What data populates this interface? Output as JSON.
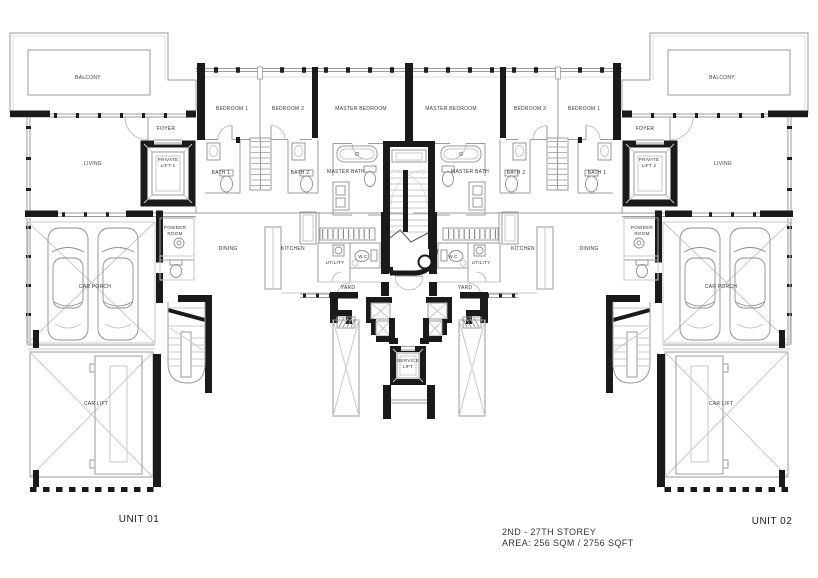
{
  "units": {
    "unit1": {
      "name": "UNIT 01",
      "rooms": {
        "balcony": "BALCONY",
        "bedroom1": "BEDROOM 1",
        "bedroom2": "BEDROOM 2",
        "master_bedroom": "MASTER BEDROOM",
        "foyer": "FOYER",
        "living": "LIVING",
        "private_lift": "PRIVATE\nLIFT-1",
        "bath1": "BATH 1",
        "bath2": "BATH 2",
        "master_bath": "MASTER BATH",
        "powder_room": "POWDER\nROOM",
        "dining": "DINING",
        "kitchen": "KITCHEN",
        "utility": "UTILITY",
        "wc": "W.C",
        "yard": "YARD",
        "car_porch": "CAR PORCH",
        "car_lift": "CAR LIFT"
      }
    },
    "unit2": {
      "name": "UNIT 02",
      "rooms": {
        "balcony": "BALCONY",
        "bedroom1": "BEDROOM 1",
        "bedroom2": "BEDROOM 2",
        "master_bedroom": "MASTER BEDROOM",
        "foyer": "FOYER",
        "living": "LIVING",
        "private_lift": "PRIVATE\nLIFT 2",
        "bath1": "BATH 1",
        "bath2": "BATH 2",
        "master_bath": "MASTER BATH",
        "powder_room": "POWDER\nROOM",
        "dining": "DINING",
        "kitchen": "KITCHEN",
        "utility": "UTILITY",
        "wc": "W.C",
        "yard": "YARD",
        "car_porch": "CAR PORCH",
        "car_lift": "CAR LIFT"
      }
    }
  },
  "common": {
    "service_lift": "SERVICE\nLIFT"
  },
  "footer": {
    "unit1_label": "UNIT 01",
    "unit2_label": "UNIT 02",
    "storey": "2ND - 27TH STOREY",
    "area": "AREA: 256 SQM / 2756 SQFT"
  },
  "colors": {
    "wall": "#1a1a1a",
    "line": "#9b9b9b",
    "background": "#ffffff"
  }
}
